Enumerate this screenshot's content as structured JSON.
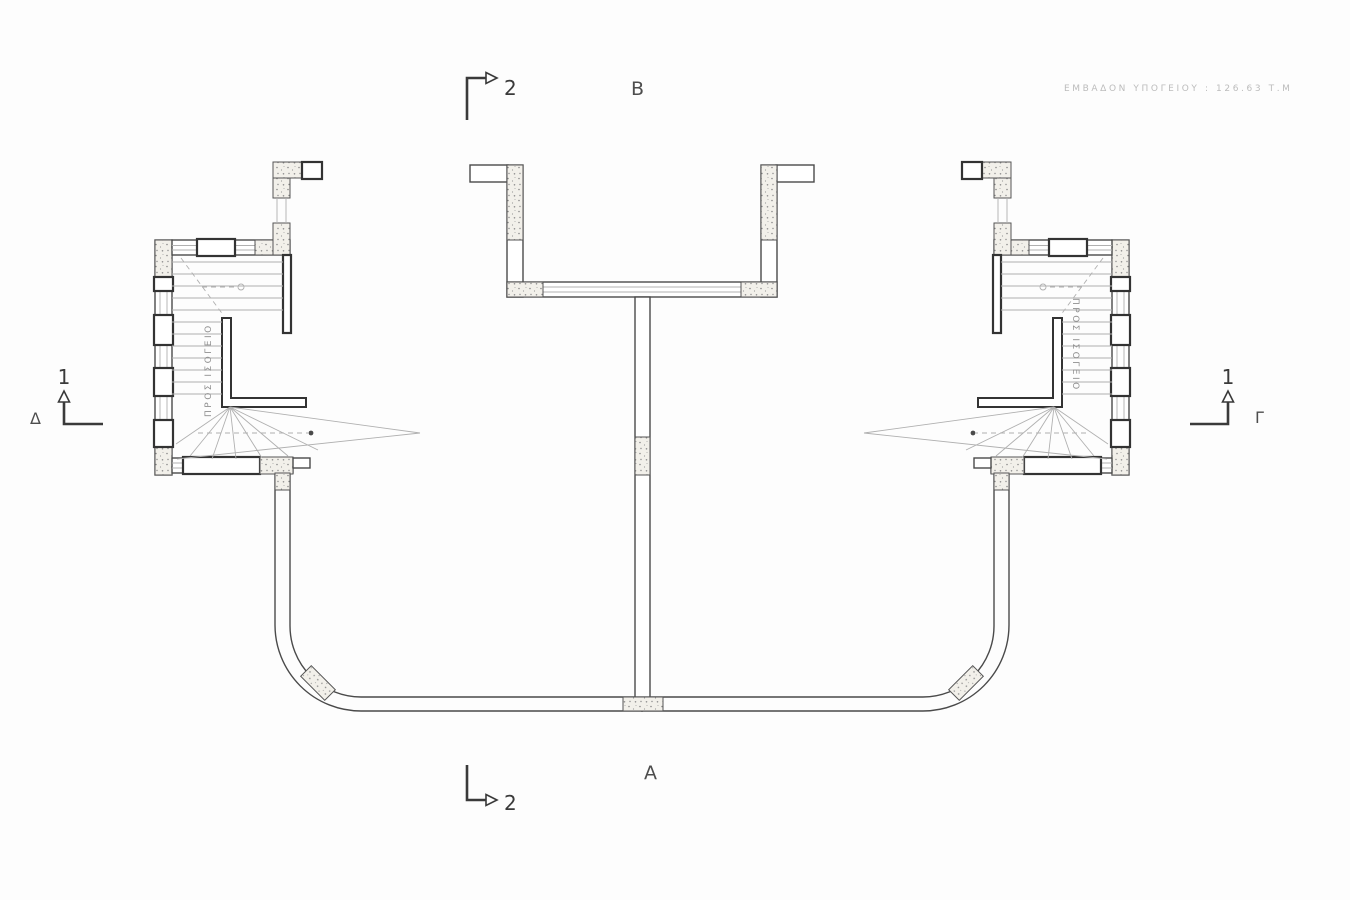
{
  "plan": {
    "annotation": "ΕΜΒΑΔΟΝ ΥΠΟΓΕΙΟΥ : 126.63 Τ.Μ",
    "region_labels": {
      "top": "Β",
      "bottom": "Α",
      "left": "Δ",
      "right": "Γ"
    },
    "section_markers": {
      "top": "2",
      "bottom": "2",
      "left": "1",
      "right": "1"
    },
    "stair_notes": {
      "left": "ΠΡΟΣ ΙΣΟΓΕΙΟ",
      "right": "ΠΡΟΣ ΙΣΟΓΕΙΟ"
    },
    "colors": {
      "line": "#4a4a4a",
      "bold_line": "#333333",
      "thin_line": "#b0b0b0",
      "marker": "#3a3a3a",
      "stipple_speck": "#8a8a8a",
      "faint_text": "#bcbcbc",
      "paper": "#fdfdfd"
    }
  }
}
